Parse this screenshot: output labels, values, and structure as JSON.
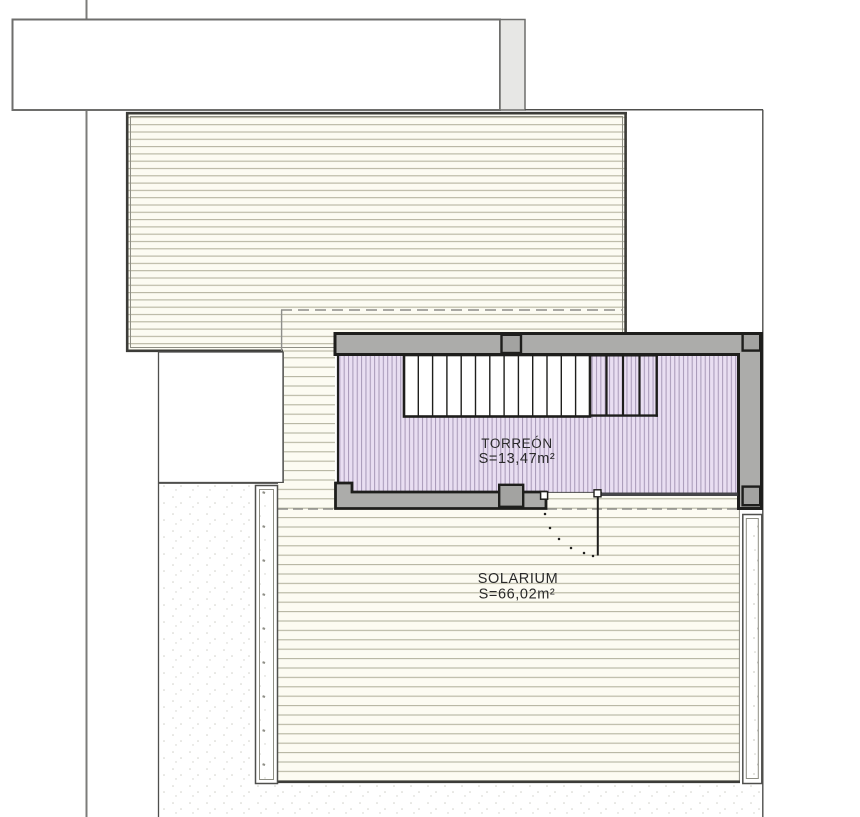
{
  "labels": {
    "torreon": {
      "name": "TORREÓN",
      "area": "S=13,47m²"
    },
    "solarium": {
      "name": "SOLARIUM",
      "area": "S=66,02m²"
    }
  },
  "colors": {
    "ink": "#1e1e1c",
    "wall": "#acacaa",
    "pillar": "#a3a3a1",
    "line-gray": "#7c7c7a",
    "outline-gray": "#6e6e6c",
    "mid": "#4f4f4d",
    "border-dark": "#3c3c38",
    "inner-line": "#8e8e84",
    "hatch": "#b5b4a0",
    "cream": "#fcfbf2",
    "purple": "#e9def2",
    "purple-line": "#a697b6",
    "chimney": "#e7e7e5",
    "stipple": "#cfcfc8",
    "speck": "#8f8f87",
    "dash": "#8e8e8a",
    "lintel": "#46464a",
    "text": "#2a2a2a"
  }
}
